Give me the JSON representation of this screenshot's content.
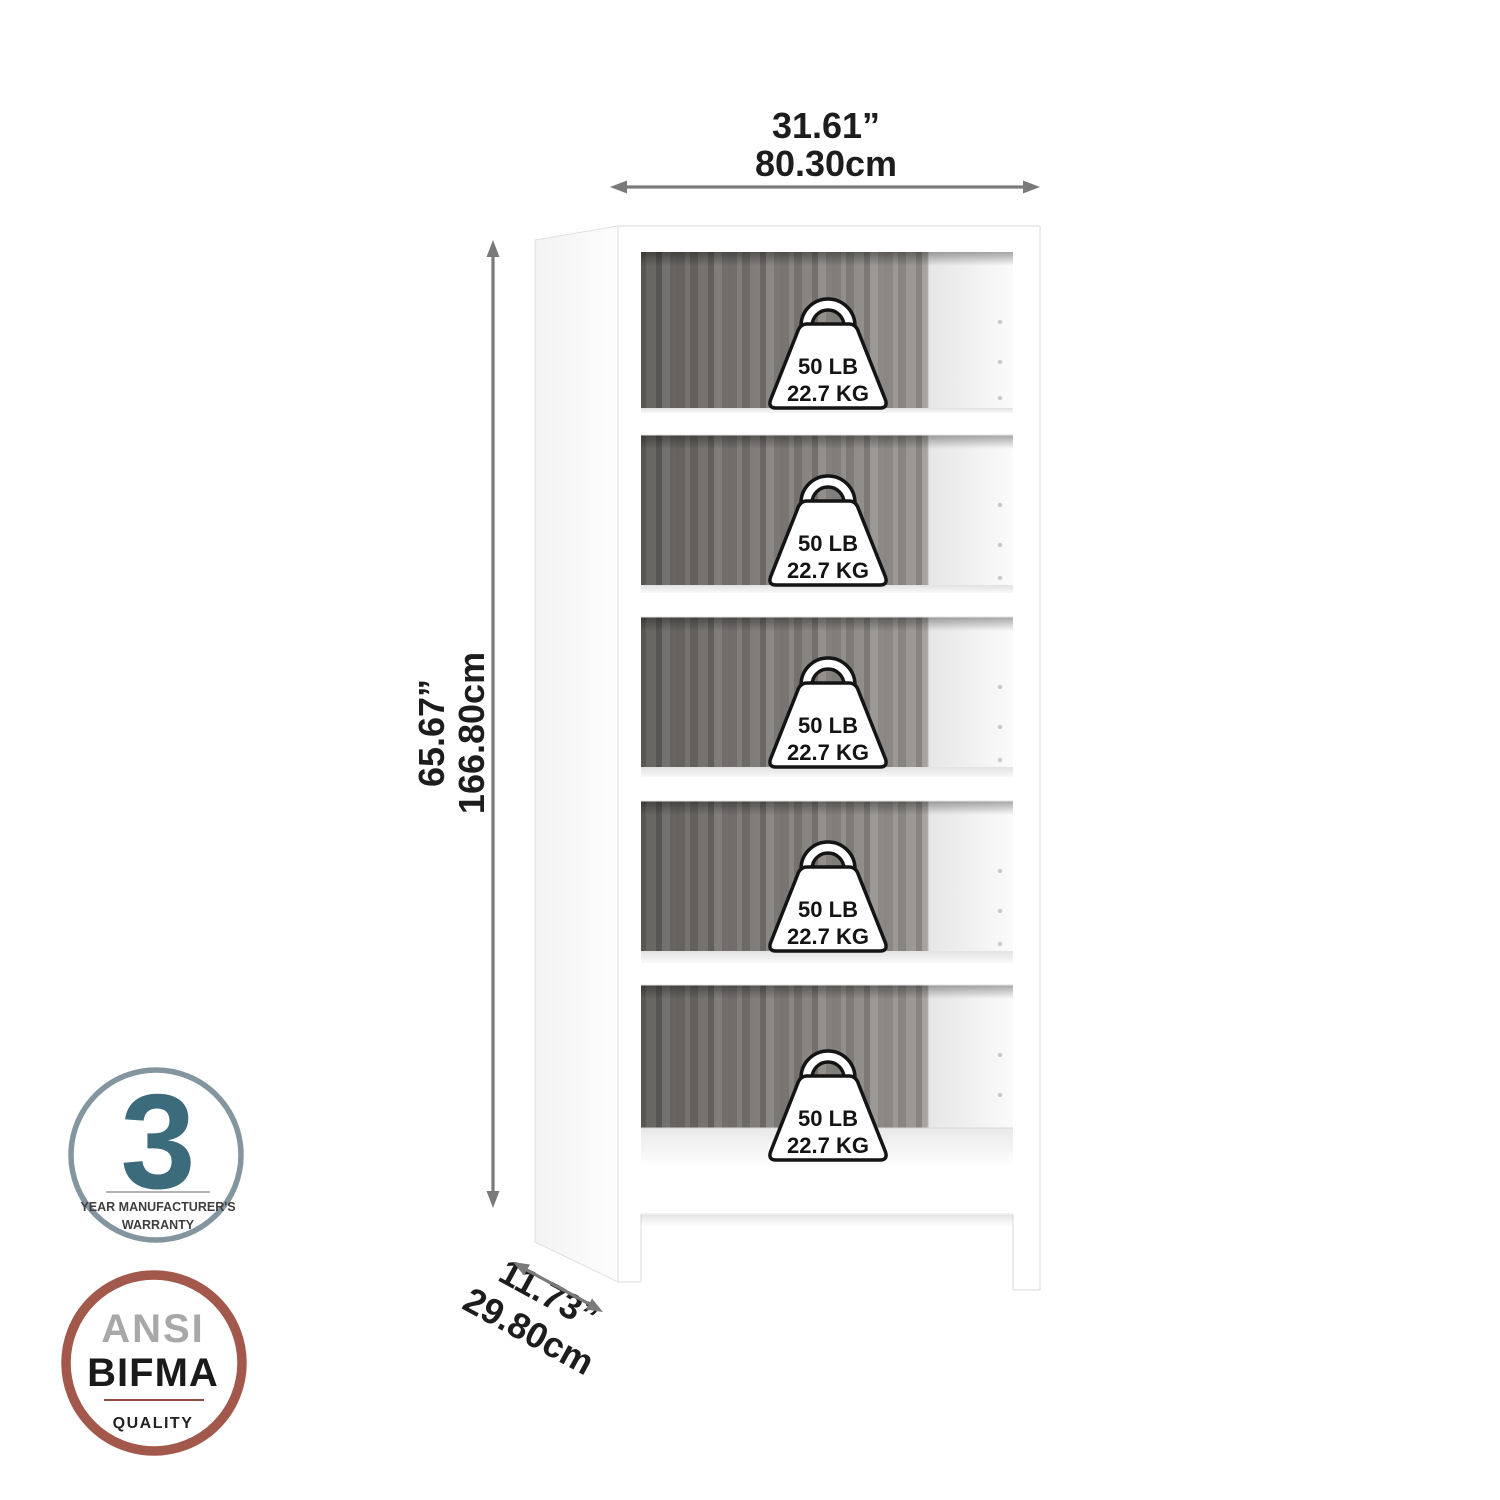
{
  "dimensions": {
    "width": {
      "inches": "31.61”",
      "cm": "80.30cm"
    },
    "height": {
      "inches": "65.67”",
      "cm": "166.80cm"
    },
    "depth": {
      "inches": "11.73”",
      "cm": "29.80cm"
    }
  },
  "shelf_capacity": {
    "pounds": "50 LB",
    "kilograms": "22.7 KG",
    "shelves": 5
  },
  "badges": {
    "warranty": {
      "years": "3",
      "line1": "YEAR MANUFACTURER'S",
      "line2": "WARRANTY"
    },
    "ansi_bifma": {
      "org1": "ANSI",
      "org2": "BIFMA",
      "label": "QUALITY"
    }
  },
  "colors": {
    "background": "#ffffff",
    "arrow_gray": "#7a7a7a",
    "label_text": "#1d1d1d",
    "back_panel_gray": "#8a8783",
    "cabinet_white": "#ffffff",
    "warranty_circle": "#8396a0",
    "warranty_number": "#3c6b7c",
    "ansi_circle": "#a2584a",
    "ansi_text_gray": "#a8a8a8"
  }
}
